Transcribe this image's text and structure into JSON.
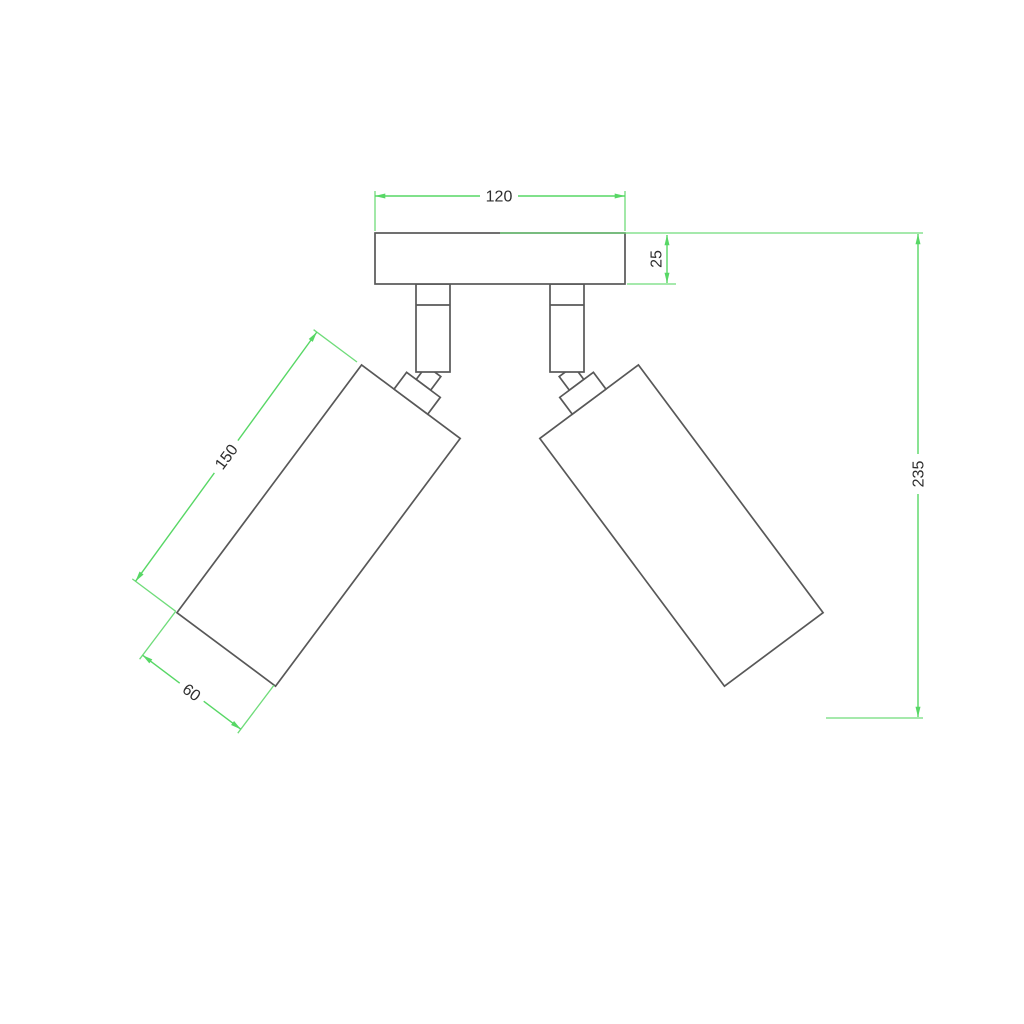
{
  "drawing": {
    "kind": "technical-dimension-drawing",
    "dimensions": {
      "plate_width": "120",
      "plate_thickness": "25",
      "cylinder_length": "150",
      "cylinder_diameter": "60",
      "overall_height": "235"
    },
    "colors": {
      "dimension_line": "#57d765",
      "outline": "#585858",
      "label_text": "#2e2e2e",
      "background": "#ffffff"
    }
  }
}
